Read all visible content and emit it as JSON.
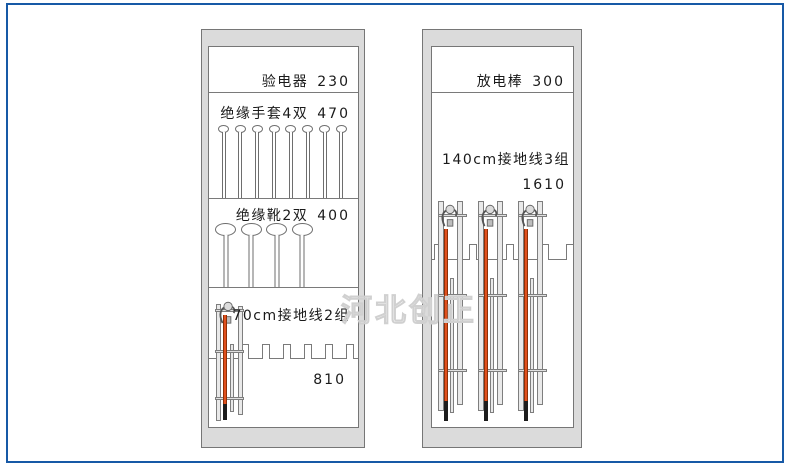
{
  "watermark": "河北创正",
  "colors": {
    "page_border": "#1759A6",
    "cabinet_frame": "#DBDBDB",
    "outline_gray": "#7A7A7A",
    "rod_orange": "#E0501E",
    "rod_tip_black": "#1C1C1C"
  },
  "left_cabinet": {
    "sections": [
      {
        "label": "验电器",
        "value": "230"
      },
      {
        "label": "绝缘手套4双",
        "value": "470",
        "hangers": 8
      },
      {
        "label": "绝缘靴2双",
        "value": "400",
        "hangers": 4
      },
      {
        "label": "70cm接地线2组",
        "value": "810",
        "racks": 1
      }
    ]
  },
  "right_cabinet": {
    "sections": [
      {
        "label": "放电棒",
        "value": "300"
      },
      {
        "label": "140cm接地线3组",
        "value": "1610",
        "racks": 3
      }
    ]
  }
}
